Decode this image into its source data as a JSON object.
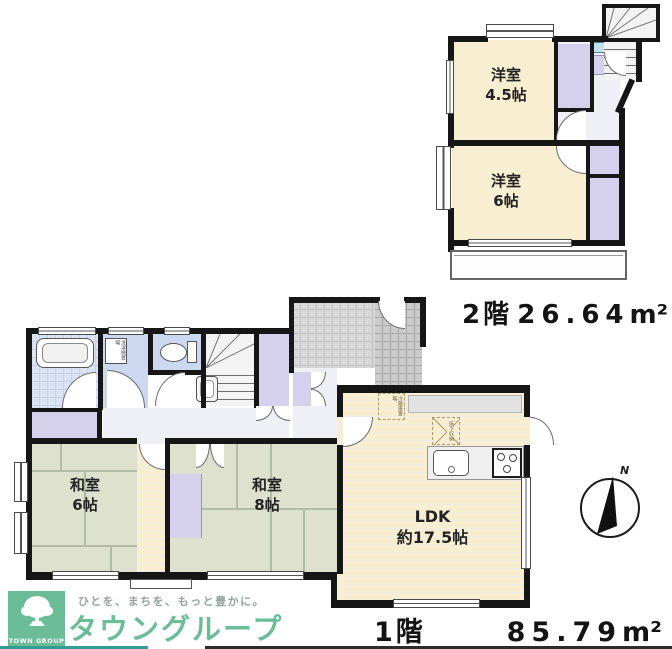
{
  "floor2": {
    "label": "2階",
    "area_value": "26.64",
    "area_unit": "m²",
    "room_a": {
      "name": "洋室",
      "size": "4.5帖"
    },
    "room_b": {
      "name": "洋室",
      "size": "6帖"
    }
  },
  "floor1": {
    "label": "1階",
    "area_value": "85.79",
    "area_unit": "m²",
    "room_washitsu6": {
      "name": "和室",
      "size": "6帖"
    },
    "room_washitsu8": {
      "name": "和室",
      "size": "8帖"
    },
    "room_ldk": {
      "name": "LDK",
      "size": "約17.5帖"
    },
    "note_laundry": "洗濯機置場",
    "note_fridge": "冷蔵庫置場",
    "note_underfloor": "床下収納"
  },
  "compass": {
    "north": "N"
  },
  "footer": {
    "tagline": "ひとを、まちを、もっと豊かに。",
    "brand": "タウングループ",
    "logo_caption": "TOWN GROUP"
  },
  "palette": {
    "wall": "#161616",
    "room_cream": "#f8efd2",
    "tatami_green": "#dde1cd",
    "closet_purple": "#d5d1ec",
    "wet_blue": "#ccd8ef",
    "brand_green": "#6abd96"
  }
}
